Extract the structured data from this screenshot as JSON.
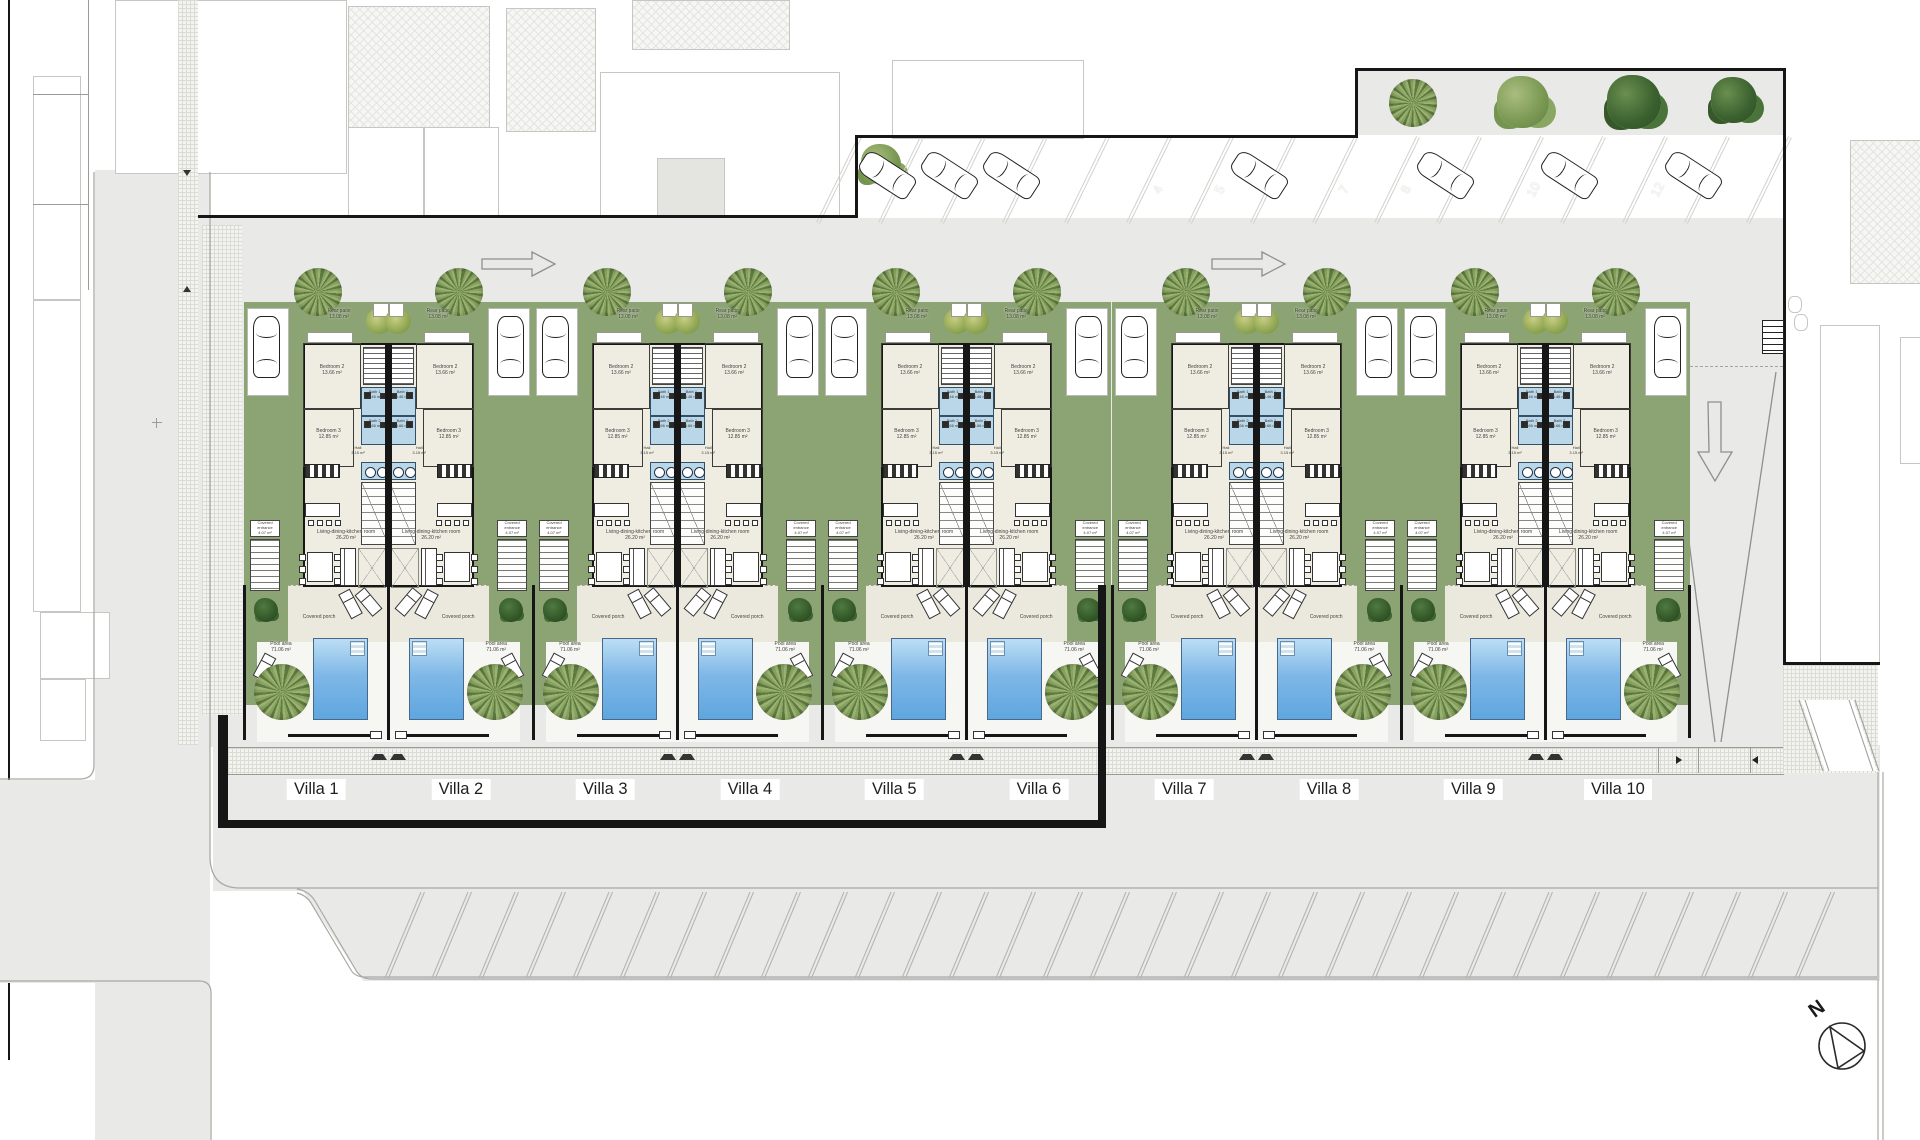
{
  "plan": {
    "villa_labels": [
      "Villa 1",
      "Villa 2",
      "Villa 3",
      "Villa 4",
      "Villa 5",
      "Villa 6",
      "Villa 7",
      "Villa 8",
      "Villa 9",
      "Villa 10"
    ],
    "compass_north": "N"
  },
  "rooms": {
    "rear_patio": {
      "name": "Rear patio",
      "area": "13.08 m²"
    },
    "bedroom2": {
      "name": "Bedroom 2",
      "area": "13.66 m²"
    },
    "bedroom3": {
      "name": "Bedroom 3",
      "area": "12.85 m²"
    },
    "bath1": {
      "name": "Bath 1",
      "area": "5.46 m²"
    },
    "bath2": {
      "name": "Bath 2",
      "area": "3.66 m²"
    },
    "hall": {
      "name": "Hall",
      "area": "3.15 m²"
    },
    "living": {
      "name": "Living-dining-kitchen room",
      "area": "26.20 m²"
    },
    "entrance": {
      "name": "Covered entrance",
      "area": "4.07 m²"
    },
    "porch": {
      "name": "Covered porch",
      "area": ""
    },
    "pool": {
      "name": "Pool area",
      "area": "71.06 m²"
    }
  },
  "parking": {
    "spaces": [
      {
        "pos": 1,
        "car": true,
        "label": ""
      },
      {
        "pos": 2,
        "car": true,
        "label": ""
      },
      {
        "pos": 3,
        "car": true,
        "label": ""
      },
      {
        "pos": 4,
        "car": false,
        "label": ""
      },
      {
        "pos": 5,
        "car": false,
        "label": "4"
      },
      {
        "pos": 6,
        "car": false,
        "label": "5"
      },
      {
        "pos": 7,
        "car": true,
        "label": ""
      },
      {
        "pos": 8,
        "car": false,
        "label": "7"
      },
      {
        "pos": 9,
        "car": false,
        "label": "8"
      },
      {
        "pos": 10,
        "car": true,
        "label": ""
      },
      {
        "pos": 11,
        "car": false,
        "label": "10"
      },
      {
        "pos": 12,
        "car": true,
        "label": ""
      },
      {
        "pos": 13,
        "car": false,
        "label": "12"
      },
      {
        "pos": 14,
        "car": true,
        "label": ""
      },
      {
        "pos": 15,
        "car": false,
        "label": ""
      }
    ]
  },
  "landscape": {
    "top_strip_trees": [
      "palm-tree",
      "light-bush",
      "dark-bush",
      "dark-bush"
    ]
  },
  "colors": {
    "garden_green": "#8ca474",
    "pool_blue": "#7fb8e7",
    "paving": "#e9e9e7",
    "bath_blue": "#bad6e9",
    "wall": "#161616"
  }
}
